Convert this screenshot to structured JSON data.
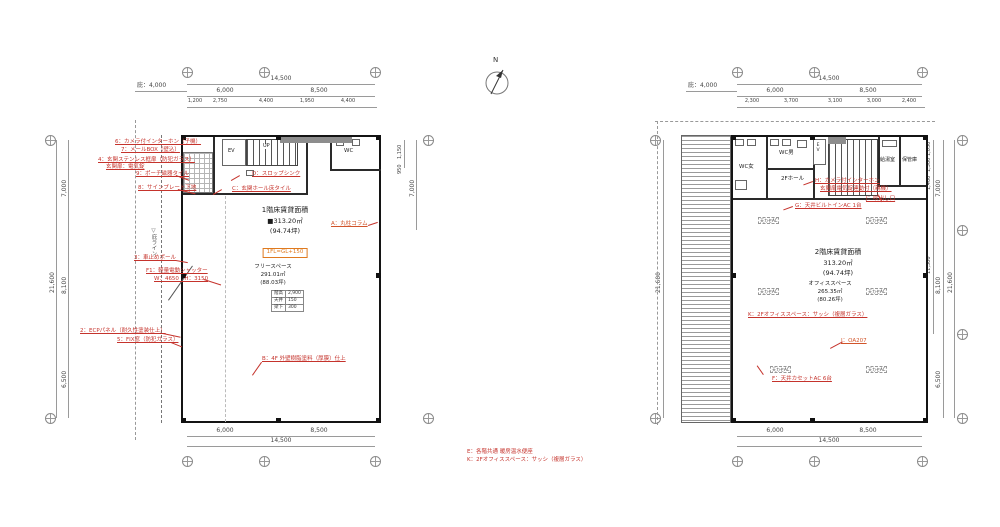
{
  "page": {
    "north_label": "N",
    "notes": [
      "E：各階共通 暖房温水便座",
      "K：2Fオフィススペース：サッシ（複層ガラス）"
    ],
    "colors": {
      "annotation_red": "#c5332c",
      "accent_orange": "#df7a1f",
      "wall_black": "#141414",
      "dim_gray": "#9a9a9a"
    }
  },
  "plan1": {
    "canopy_dim": "庇：4,000",
    "dims_top": {
      "total": "14,500",
      "segs1": [
        "6,000",
        "8,500"
      ],
      "segs2": [
        "1,200",
        "2,750",
        "4,400",
        "1,950",
        "4,400"
      ]
    },
    "dims_bottom": {
      "segs": [
        "6,000",
        "8,500"
      ],
      "total": "14,500"
    },
    "dims_left": {
      "segs": [
        "7,000",
        "8,100",
        "6,500"
      ],
      "total": "21,600"
    },
    "dims_right": {
      "segs_small": [
        "1,150",
        "950"
      ],
      "main": "7,000"
    },
    "center": {
      "title": "1階床賃貸面積",
      "area": "■313.20㎡",
      "tsubo": "(94.74坪)",
      "level_tag": "1FL=GL+150",
      "sub_name": "フリースペース",
      "sub_area": "291.01㎡",
      "sub_tsubo": "(88.03坪)"
    },
    "spec_table": {
      "r0": [
        "階高",
        "2,900"
      ],
      "r1": [
        "天井",
        "150"
      ],
      "r2": [
        "梁下",
        "300"
      ]
    },
    "rooms": {
      "wc": "WC",
      "ev": "EV",
      "up": "UP"
    },
    "eave_line": "▽庇ライン",
    "ann": {
      "a1": "6：カメラ付インターホン（子機）",
      "a2": "7：メールBOX（壁込）",
      "a3": "4：玄関ステンレス框扉（防犯ガラス）",
      "a3b": "玄関扉：電気錠",
      "a4": "9：ポーチ磁器タイル",
      "a5": "8：サインプレート下地",
      "a6": "D：スロップシンク",
      "a7": "C：玄関ホール床タイル",
      "a8": "3：車止めポール",
      "a9": "F1：軽量電動シャッター",
      "a9b": "W：4650　H：3150",
      "a10": "2：ECPパネル（耐久性塗装仕上）",
      "a11": "5：FIX窓（防犯ガラス）",
      "a12": "B：4F 外壁樹脂塗料（厚膜）仕上",
      "a13": "A：丸柱コラム"
    }
  },
  "plan2": {
    "canopy_dim": "庇：4,000",
    "dims_top": {
      "total": "14,500",
      "segs1": [
        "6,000",
        "8,500"
      ],
      "segs2": [
        "2,300",
        "3,700",
        "3,100",
        "3,000",
        "2,400"
      ]
    },
    "dims_bottom": {
      "segs": [
        "6,000",
        "8,500"
      ],
      "total": "14,500"
    },
    "dims_left": {
      "total": "21,600"
    },
    "dims_right": {
      "segs_small": [
        "1,050",
        "1,300",
        "1,400"
      ],
      "mid": "11,300",
      "segs": [
        "7,000",
        "8,100",
        "6,500"
      ],
      "total": "21,600"
    },
    "center": {
      "title": "2階床賃貸面積",
      "area": "313.20㎡",
      "tsubo": "(94.74坪)",
      "sub_name": "オフィススペース",
      "sub_area": "265.35㎡",
      "sub_tsubo": "(80.26坪)"
    },
    "rooms": {
      "wc_w": "WC女",
      "wc_m": "WC男",
      "hall": "2Fホール",
      "ev": "EV",
      "kitchen": "給湯室",
      "storage": "保管庫"
    },
    "ac_tag": "天カセAC",
    "ann": {
      "h1": "H：カメラ付インターホン",
      "h2": "玄関扉電気錠連動付（親機）",
      "g": "G：天井ビルトインAC 1台",
      "j": "J：吹出し口",
      "k": "K：2Fオフィススペース：サッシ（複層ガラス）",
      "i": "I：OA207",
      "f": "F：天井カセットAC 6台"
    }
  }
}
